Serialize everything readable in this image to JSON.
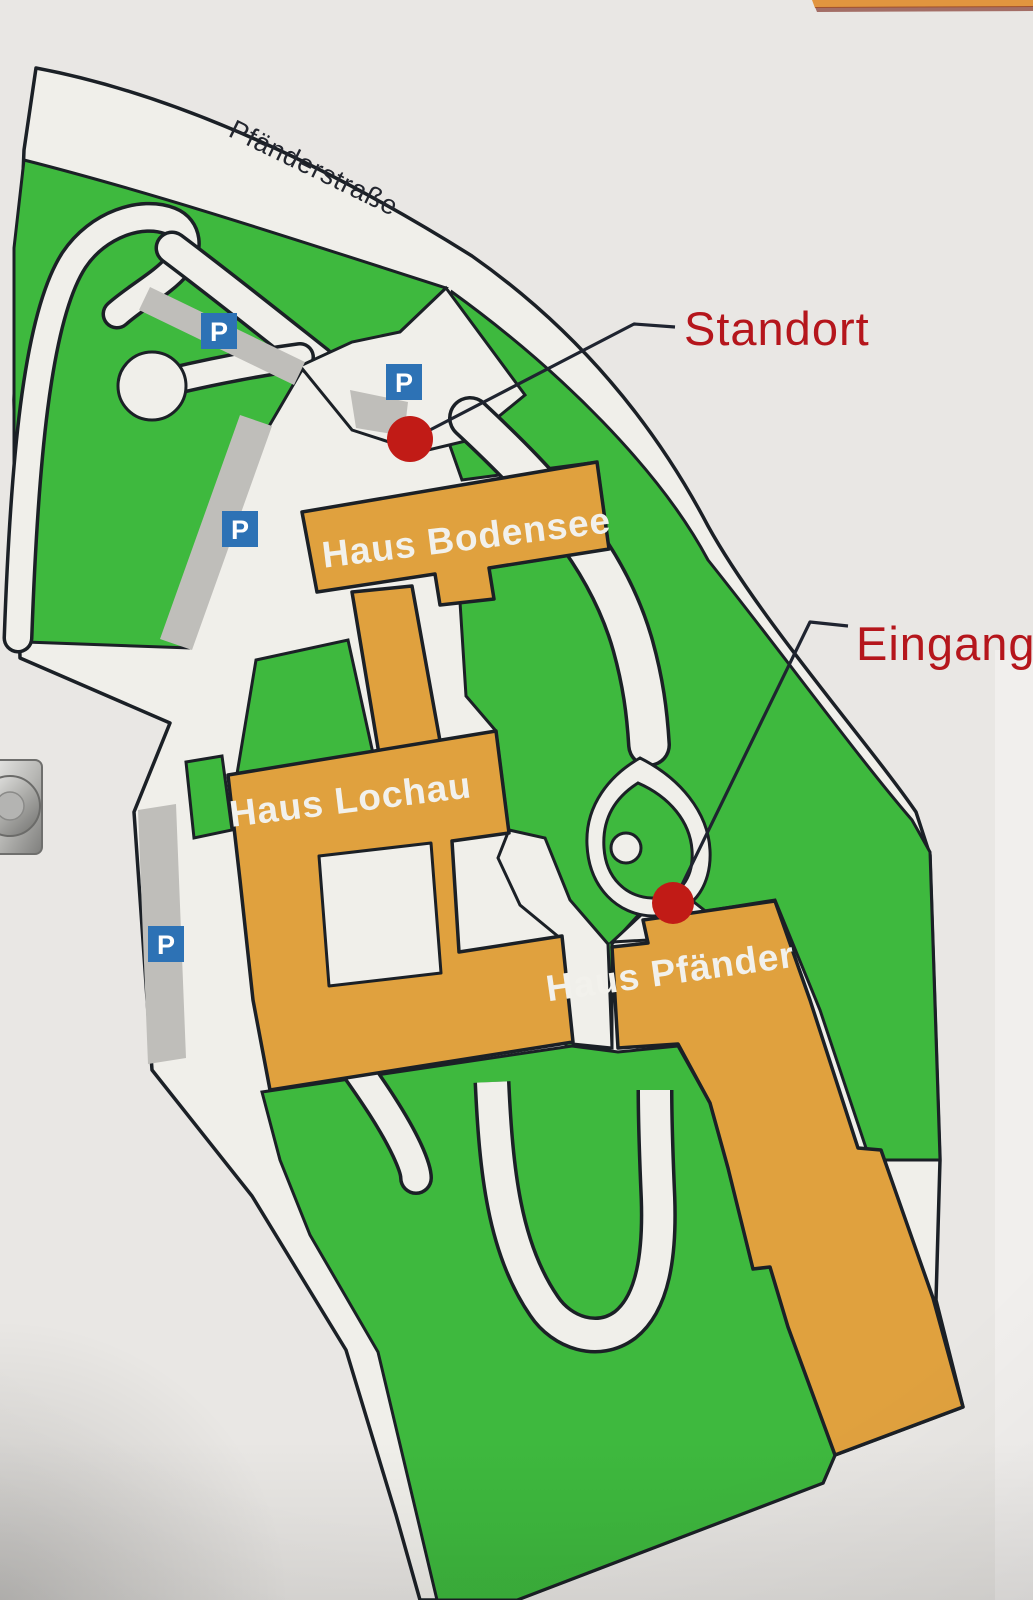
{
  "sign": {
    "street": "Pfänderstraße"
  },
  "buildings": [
    {
      "id": "bodensee",
      "label": "Haus Bodensee"
    },
    {
      "id": "lochau",
      "label": "Haus Lochau"
    },
    {
      "id": "pfaender",
      "label": "Haus Pfänder"
    }
  ],
  "annotations": [
    {
      "id": "standort",
      "label": "Standort"
    },
    {
      "id": "eingang",
      "label": "Eingang"
    }
  ],
  "parking": {
    "letter": "P",
    "count": 4
  },
  "markers": {
    "standort": "red-dot",
    "eingang": "red-dot"
  },
  "colors": {
    "green": "#3eb93e",
    "building_orange": "#e0a13e",
    "map_cream": "#f0efea",
    "sign_background": "#e9e7e4",
    "outline": "#1b2026",
    "parking_blue": "#2d72b5",
    "marker_red": "#c11b16",
    "label_red": "#b5161c",
    "gray_strip": "#bfbeba",
    "frame_orange": "#e1953f"
  }
}
